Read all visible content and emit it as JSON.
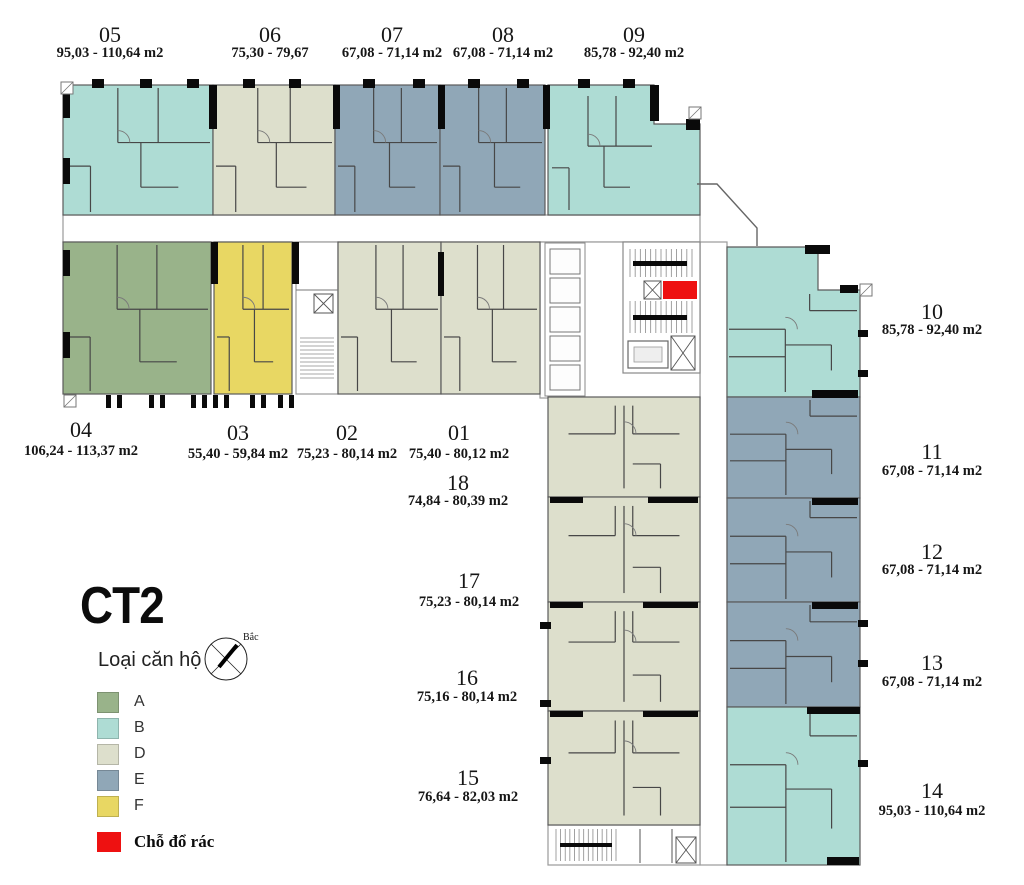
{
  "title": "CT2",
  "legend": {
    "heading": "Loại căn hộ",
    "items": [
      {
        "label": "A",
        "color": "#99b38a"
      },
      {
        "label": "B",
        "color": "#aedcd4"
      },
      {
        "label": "D",
        "color": "#dddfcc"
      },
      {
        "label": "E",
        "color": "#90a7b7"
      },
      {
        "label": "F",
        "color": "#e8d763"
      }
    ],
    "trash": {
      "label": "Chỗ đổ rác",
      "color": "#ee1111"
    }
  },
  "compass": {
    "label": "Bắc"
  },
  "plan": {
    "units": [
      {
        "id": "05",
        "number": "05",
        "area": "95,03 - 110,64 m2",
        "type": "B"
      },
      {
        "id": "06",
        "number": "06",
        "area": "75,30 - 79,67",
        "type": "D"
      },
      {
        "id": "07",
        "number": "07",
        "area": "67,08 - 71,14 m2",
        "type": "E"
      },
      {
        "id": "08",
        "number": "08",
        "area": "67,08 - 71,14 m2",
        "type": "E"
      },
      {
        "id": "09",
        "number": "09",
        "area": "85,78 - 92,40 m2",
        "type": "B"
      },
      {
        "id": "04",
        "number": "04",
        "area": "106,24 - 113,37 m2",
        "type": "A"
      },
      {
        "id": "03",
        "number": "03",
        "area": "55,40 - 59,84 m2",
        "type": "F"
      },
      {
        "id": "02",
        "number": "02",
        "area": "75,23 - 80,14 m2",
        "type": "D"
      },
      {
        "id": "01",
        "number": "01",
        "area": "75,40 - 80,12 m2",
        "type": "D"
      },
      {
        "id": "18",
        "number": "18",
        "area": "74,84 - 80,39 m2",
        "type": "D"
      },
      {
        "id": "17",
        "number": "17",
        "area": "75,23 - 80,14 m2",
        "type": "D"
      },
      {
        "id": "16",
        "number": "16",
        "area": "75,16 - 80,14 m2",
        "type": "D"
      },
      {
        "id": "15",
        "number": "15",
        "area": "76,64 - 82,03 m2",
        "type": "D"
      },
      {
        "id": "10",
        "number": "10",
        "area": "85,78 - 92,40 m2",
        "type": "B"
      },
      {
        "id": "11",
        "number": "11",
        "area": "67,08 - 71,14 m2",
        "type": "E"
      },
      {
        "id": "12",
        "number": "12",
        "area": "67,08 - 71,14 m2",
        "type": "E"
      },
      {
        "id": "13",
        "number": "13",
        "area": "67,08 - 71,14 m2",
        "type": "E"
      },
      {
        "id": "14",
        "number": "14",
        "area": "95,03 - 110,64 m2",
        "type": "B"
      }
    ]
  }
}
